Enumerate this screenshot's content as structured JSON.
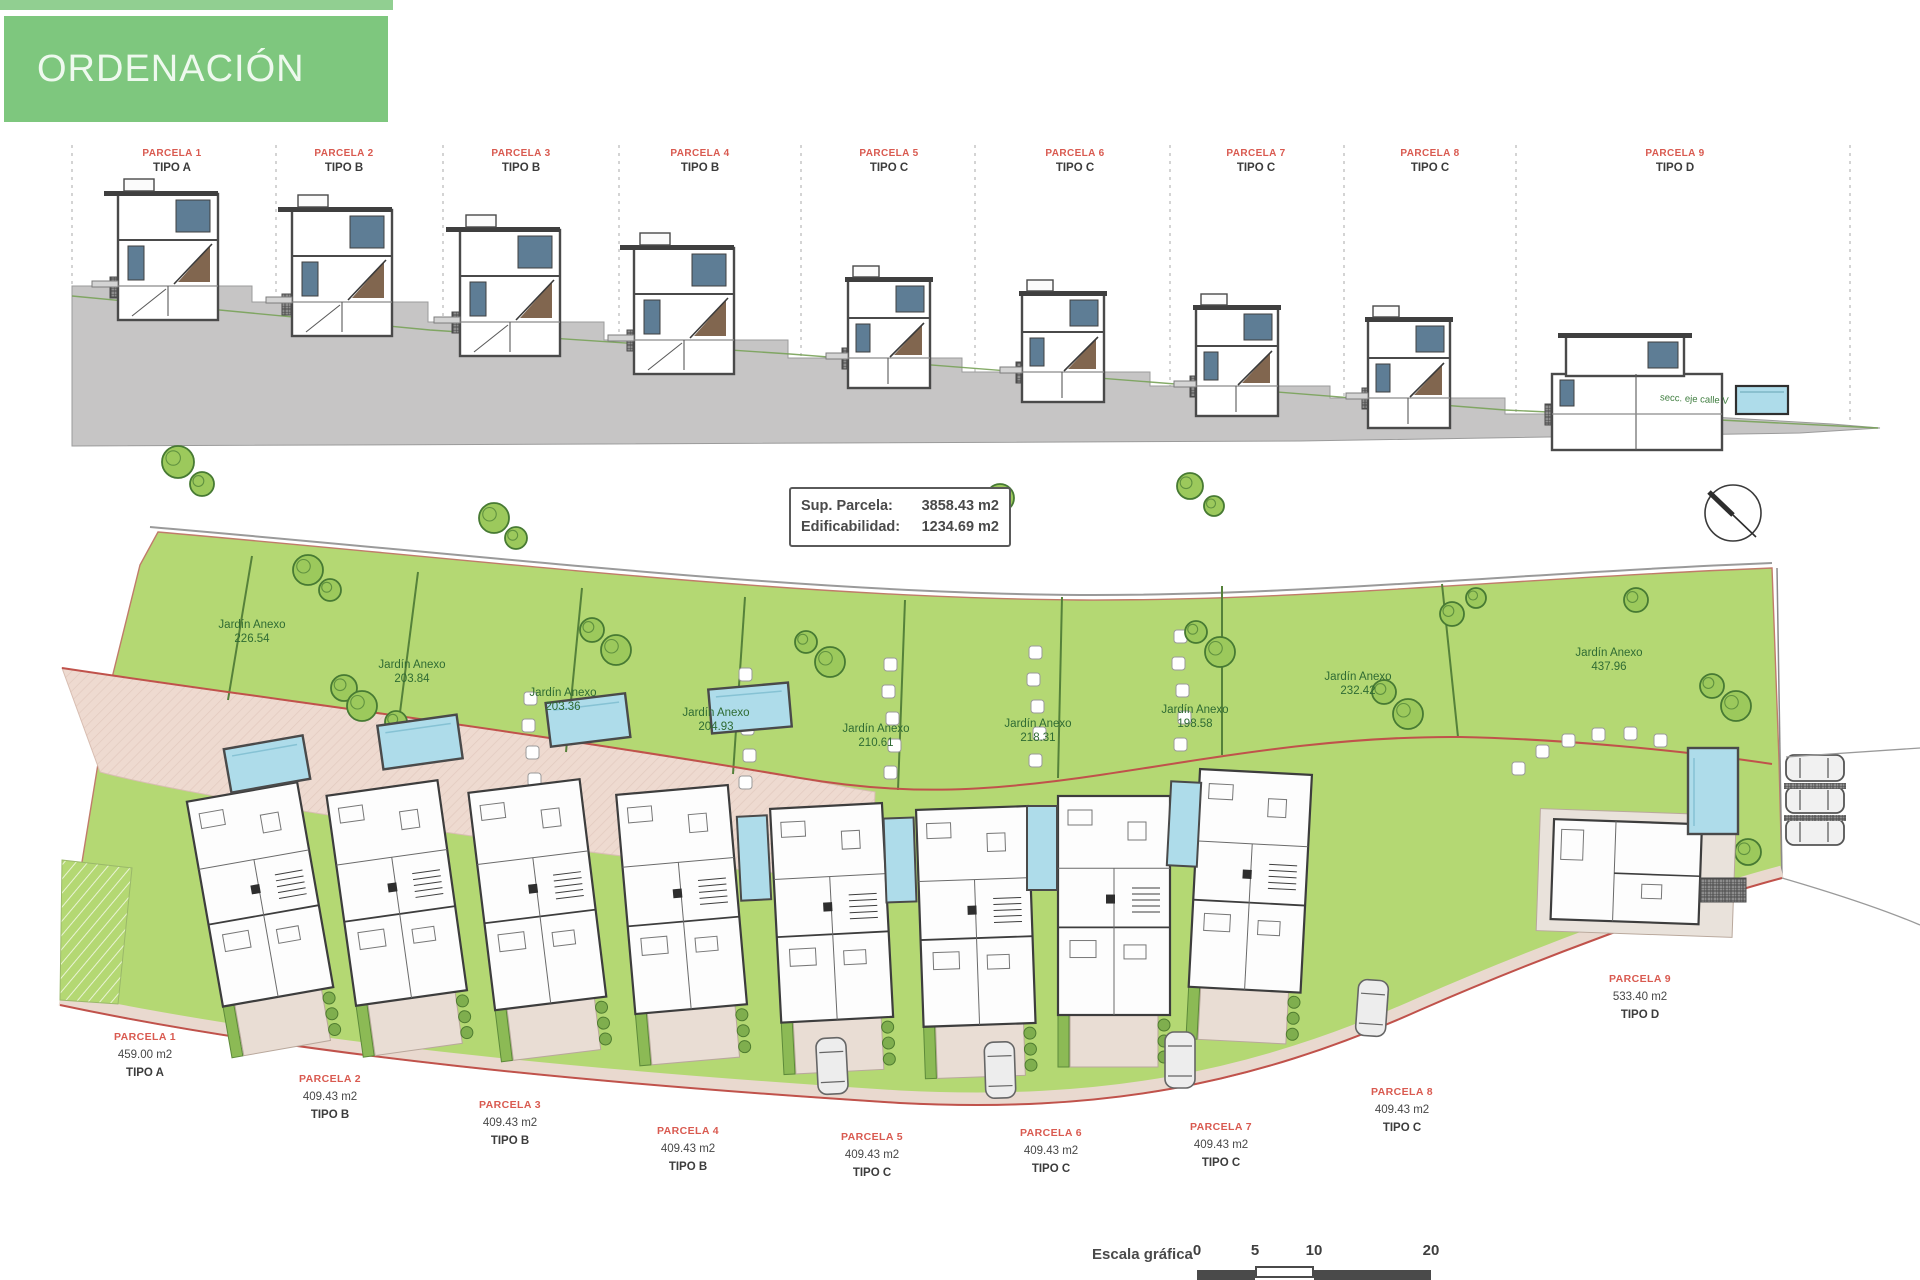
{
  "banner": {
    "title": "ORDENACIÓN"
  },
  "elevation": {
    "parcels": [
      {
        "name": "PARCELA 1",
        "tipo": "TIPO A"
      },
      {
        "name": "PARCELA 2",
        "tipo": "TIPO B"
      },
      {
        "name": "PARCELA 3",
        "tipo": "TIPO B"
      },
      {
        "name": "PARCELA 4",
        "tipo": "TIPO B"
      },
      {
        "name": "PARCELA 5",
        "tipo": "TIPO C"
      },
      {
        "name": "PARCELA 6",
        "tipo": "TIPO C"
      },
      {
        "name": "PARCELA 7",
        "tipo": "TIPO C"
      },
      {
        "name": "PARCELA 8",
        "tipo": "TIPO C"
      },
      {
        "name": "PARCELA 9",
        "tipo": "TIPO D"
      }
    ],
    "note": "secc. eje calle V"
  },
  "plan": {
    "info": {
      "sup_label": "Sup. Parcela:",
      "sup_value": "3858.43 m2",
      "edif_label": "Edificabilidad:",
      "edif_value": "1234.69 m2"
    },
    "gardens": [
      {
        "label": "Jardín Anexo",
        "area": "226.54"
      },
      {
        "label": "Jardín Anexo",
        "area": "203.84"
      },
      {
        "label": "Jardín Anexo",
        "area": "203.36"
      },
      {
        "label": "Jardín Anexo",
        "area": "204.93"
      },
      {
        "label": "Jardín Anexo",
        "area": "210.61"
      },
      {
        "label": "Jardín Anexo",
        "area": "218.31"
      },
      {
        "label": "Jardín Anexo",
        "area": "198.58"
      },
      {
        "label": "Jardín Anexo",
        "area": "232.42"
      },
      {
        "label": "Jardín Anexo",
        "area": "437.96"
      }
    ],
    "plots": [
      {
        "name": "PARCELA 1",
        "area": "459.00 m2",
        "tipo": "TIPO A"
      },
      {
        "name": "PARCELA 2",
        "area": "409.43 m2",
        "tipo": "TIPO B"
      },
      {
        "name": "PARCELA 3",
        "area": "409.43 m2",
        "tipo": "TIPO B"
      },
      {
        "name": "PARCELA 4",
        "area": "409.43 m2",
        "tipo": "TIPO B"
      },
      {
        "name": "PARCELA 5",
        "area": "409.43 m2",
        "tipo": "TIPO C"
      },
      {
        "name": "PARCELA 6",
        "area": "409.43 m2",
        "tipo": "TIPO C"
      },
      {
        "name": "PARCELA 7",
        "area": "409.43 m2",
        "tipo": "TIPO C"
      },
      {
        "name": "PARCELA 8",
        "area": "409.43 m2",
        "tipo": "TIPO C"
      },
      {
        "name": "PARCELA 9",
        "area": "533.40 m2",
        "tipo": "TIPO D"
      }
    ]
  },
  "scale": {
    "label": "Escala gráfica",
    "ticks": [
      "0",
      "5",
      "10",
      "20"
    ]
  },
  "colors": {
    "banner_green": "#7ec77e",
    "garden_green": "#b4d873",
    "garden_text": "#2f6b33",
    "label_red": "#d95a50",
    "boundary_red": "#c0524b",
    "pink_band": "#eedad0",
    "pool_blue": "#aedcea",
    "ground_gray": "#c6c5c5",
    "window_blue": "#5e7d95"
  }
}
